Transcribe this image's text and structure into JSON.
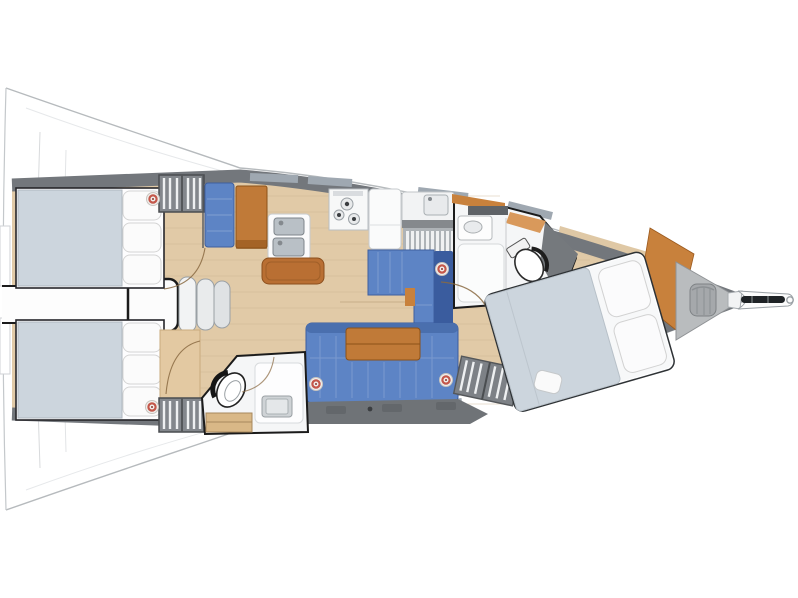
{
  "diagram": {
    "type": "boat-floor-plan",
    "view": "top-down",
    "subject": "sailing yacht interior layout",
    "orientation": "bow-right-stern-left"
  },
  "colors": {
    "hull_outline": "#b6babd",
    "deck_band": "#73777c",
    "deck_window": "#9fa8b1",
    "floor_wood": "#e1caa7",
    "plank_line": "#c9ad85",
    "upholstery_blue": "#5d84c5",
    "upholstery_blue_dark": "#3a5c9e",
    "wood_furniture": "#c07a38",
    "wood_trim": "#c8813c",
    "bed_blanket": "#ccd5dd",
    "room_white": "#f5f6f7",
    "locker_gray": "#6f7377",
    "panel_gray": "#75797d",
    "anchor_locker": "#b9bcbe",
    "speaker_accent": "#c4574a",
    "stainless": "#b9c0c6",
    "board_wood": "#b96f33"
  },
  "rooms": [
    {
      "name": "aft-port-cabin",
      "features": [
        "double-berth",
        "pillows",
        "hanging-locker",
        "speaker"
      ]
    },
    {
      "name": "aft-starboard-cabin",
      "features": [
        "double-berth",
        "pillows",
        "vanity",
        "hanging-locker",
        "speaker"
      ]
    },
    {
      "name": "companionway",
      "features": [
        "engine-box",
        "three-steps"
      ]
    },
    {
      "name": "galley",
      "features": [
        "nav-seat",
        "chart-table",
        "double-sink",
        "cutting-board",
        "three-burner-stove",
        "counter",
        "dish-rack"
      ]
    },
    {
      "name": "salon",
      "features": [
        "port-dinette",
        "starboard-sofa",
        "folding-table",
        "storage-lockers",
        "speakers"
      ]
    },
    {
      "name": "aft-head",
      "features": [
        "toilet",
        "sink",
        "shower",
        "drawers"
      ]
    },
    {
      "name": "forward-head",
      "features": [
        "toilet",
        "sink",
        "shower",
        "counter"
      ]
    },
    {
      "name": "forward-cabin",
      "features": [
        "v-berth",
        "pillows",
        "hanging-locker",
        "wood-panel"
      ]
    },
    {
      "name": "bow",
      "features": [
        "anchor-locker",
        "rope-bag",
        "bowsprit",
        "anchor-roller"
      ]
    }
  ]
}
